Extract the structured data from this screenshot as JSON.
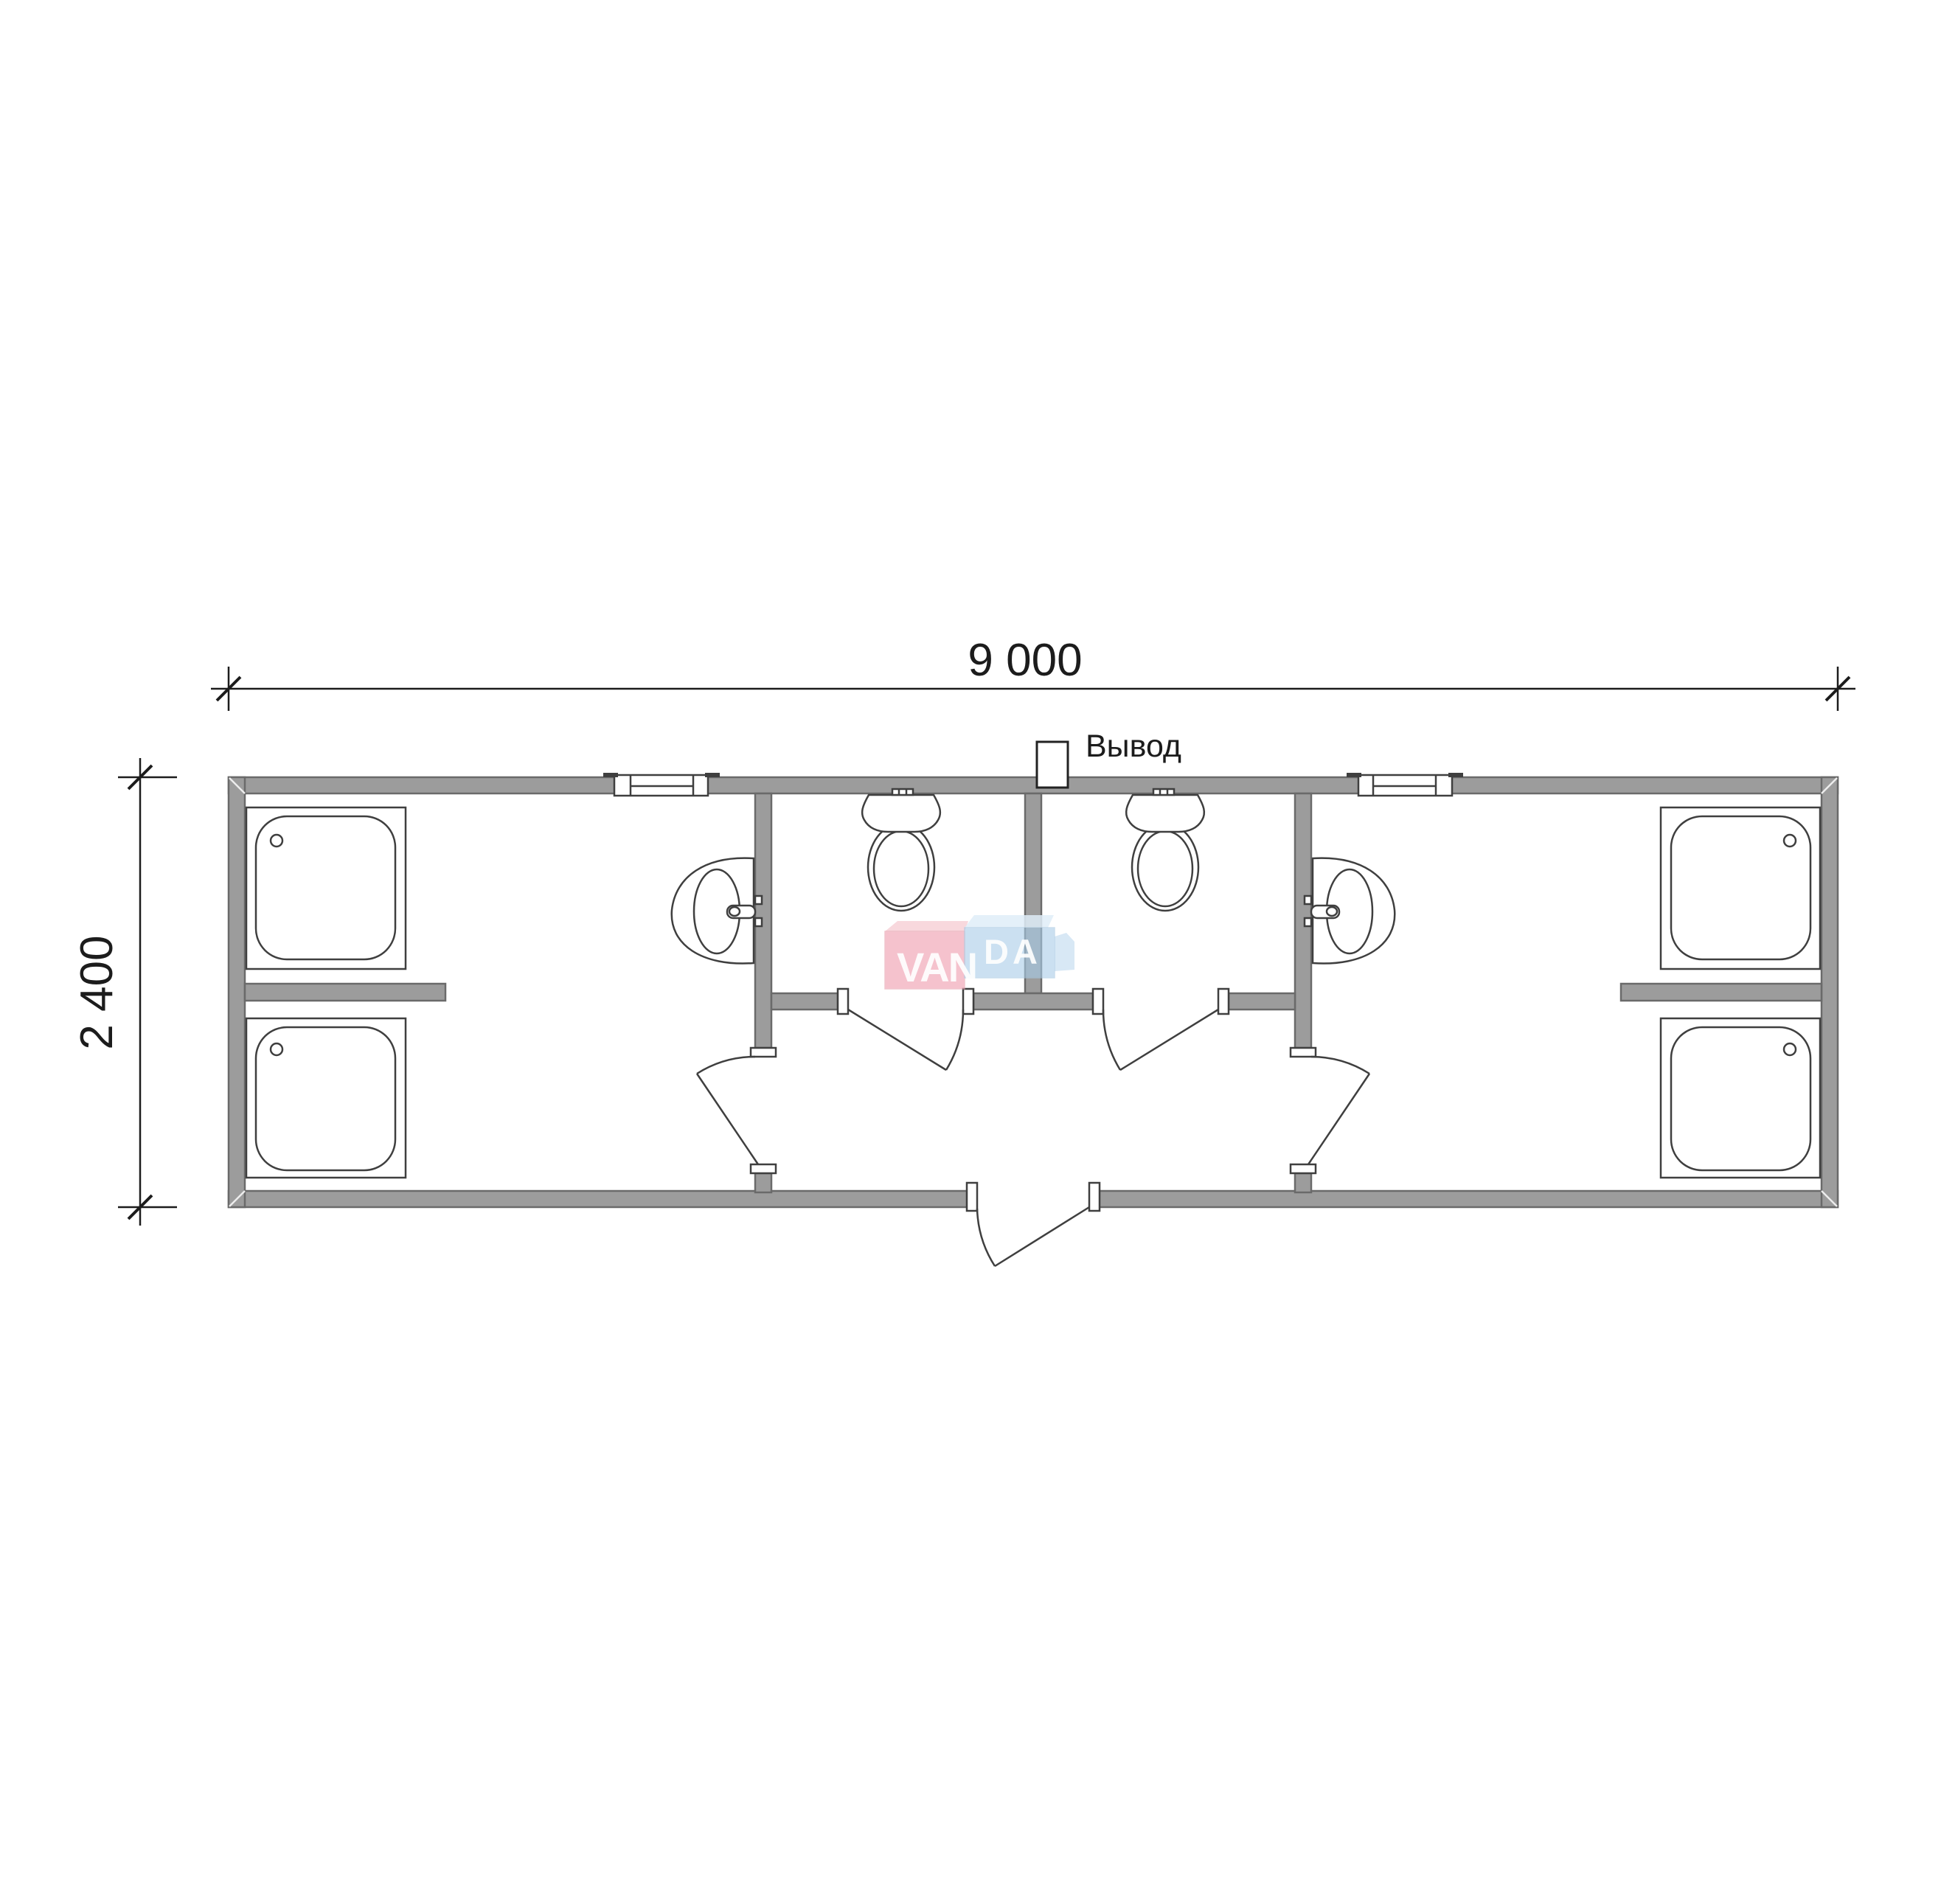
{
  "drawing": {
    "outlet_label": "Вывод",
    "dim_width": "9 000",
    "dim_height": "2 400"
  },
  "watermark": {
    "brand": "VANDA",
    "brand_left": "VAN",
    "brand_right": "DA"
  },
  "colors": {
    "wall_fill": "#9c9c9c",
    "wall_stroke": "#6a6a6a",
    "line_color": "#3f3f3f",
    "dim_color": "#1c1c1c",
    "logo_pink_top": "#f6ced5",
    "logo_pink_face": "#ef9daf",
    "logo_pink_edge": "#e8a2b0",
    "logo_blue_top": "#dfedf8",
    "logo_blue_face": "#a9cde9",
    "logo_blue_edge": "#a8c9e2",
    "logo_text": "#ffffff"
  }
}
